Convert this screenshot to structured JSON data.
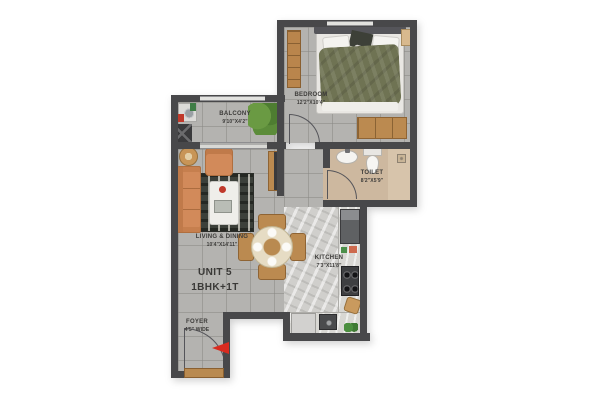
{
  "unit": {
    "title": "UNIT 5",
    "subtitle": "1BHK+1T"
  },
  "rooms": {
    "bedroom": {
      "label": "BEDROOM",
      "dims": "12'2\"X10'4\""
    },
    "balcony": {
      "label": "BALCONY",
      "dims": "9'10\"X4'2\""
    },
    "living": {
      "label": "LIVING & DINING",
      "dims": "10'4\"X14'11\""
    },
    "toilet": {
      "label": "TOILET",
      "dims": "8'2\"X5'9\""
    },
    "kitchen": {
      "label": "KITCHEN",
      "dims": "7'3\"X11'8\""
    },
    "foyer": {
      "label": "FOYER",
      "dims": "4'5\" WIDE"
    }
  },
  "colors": {
    "wall": "#48484a",
    "tile_floor": "#b4b3b0",
    "toilet_floor": "#cdb89f",
    "kitchen_floor": "#d0cfcc",
    "wood": "#bb8a50",
    "sofa": "#d28a5a",
    "duvet": "#6f7353",
    "plant": "#5c8c3a",
    "entry_arrow": "#d92b1f"
  },
  "furniture": [
    "bed",
    "wardrobe",
    "dresser",
    "nightstand",
    "sofa",
    "armchair",
    "coffee-table",
    "rug",
    "side-table",
    "tv-unit",
    "dining-table",
    "dining-chairs",
    "washing-machine",
    "utility-shaft",
    "plant",
    "wash-basin",
    "wc",
    "shower-drain",
    "fridge",
    "hob",
    "kitchen-sink",
    "cutting-board",
    "entry-arrow"
  ]
}
